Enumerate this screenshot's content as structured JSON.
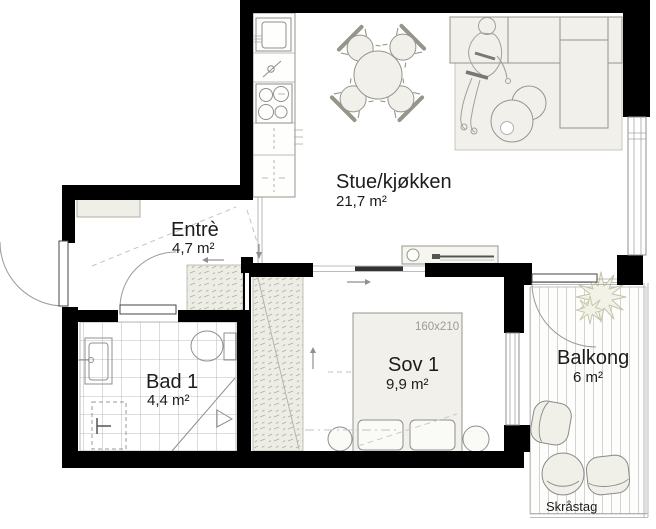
{
  "plan": {
    "rooms": [
      {
        "name": "Stue/kjøkken",
        "area": "21,7 m²"
      },
      {
        "name": "Entrè",
        "area": "4,7 m²"
      },
      {
        "name": "Bad 1",
        "area": "4,4 m²"
      },
      {
        "name": "Sov 1",
        "area": "9,9 m²"
      },
      {
        "name": "Balkong",
        "area": "6 m²"
      }
    ],
    "bed_dimension": "160x210",
    "balcony_note": "Skråstag",
    "colors": {
      "wall": "#000000",
      "furniture_fill": "#f1f0ea",
      "line": "#8f8f8f",
      "dim_text": "#9b9b9b"
    }
  }
}
